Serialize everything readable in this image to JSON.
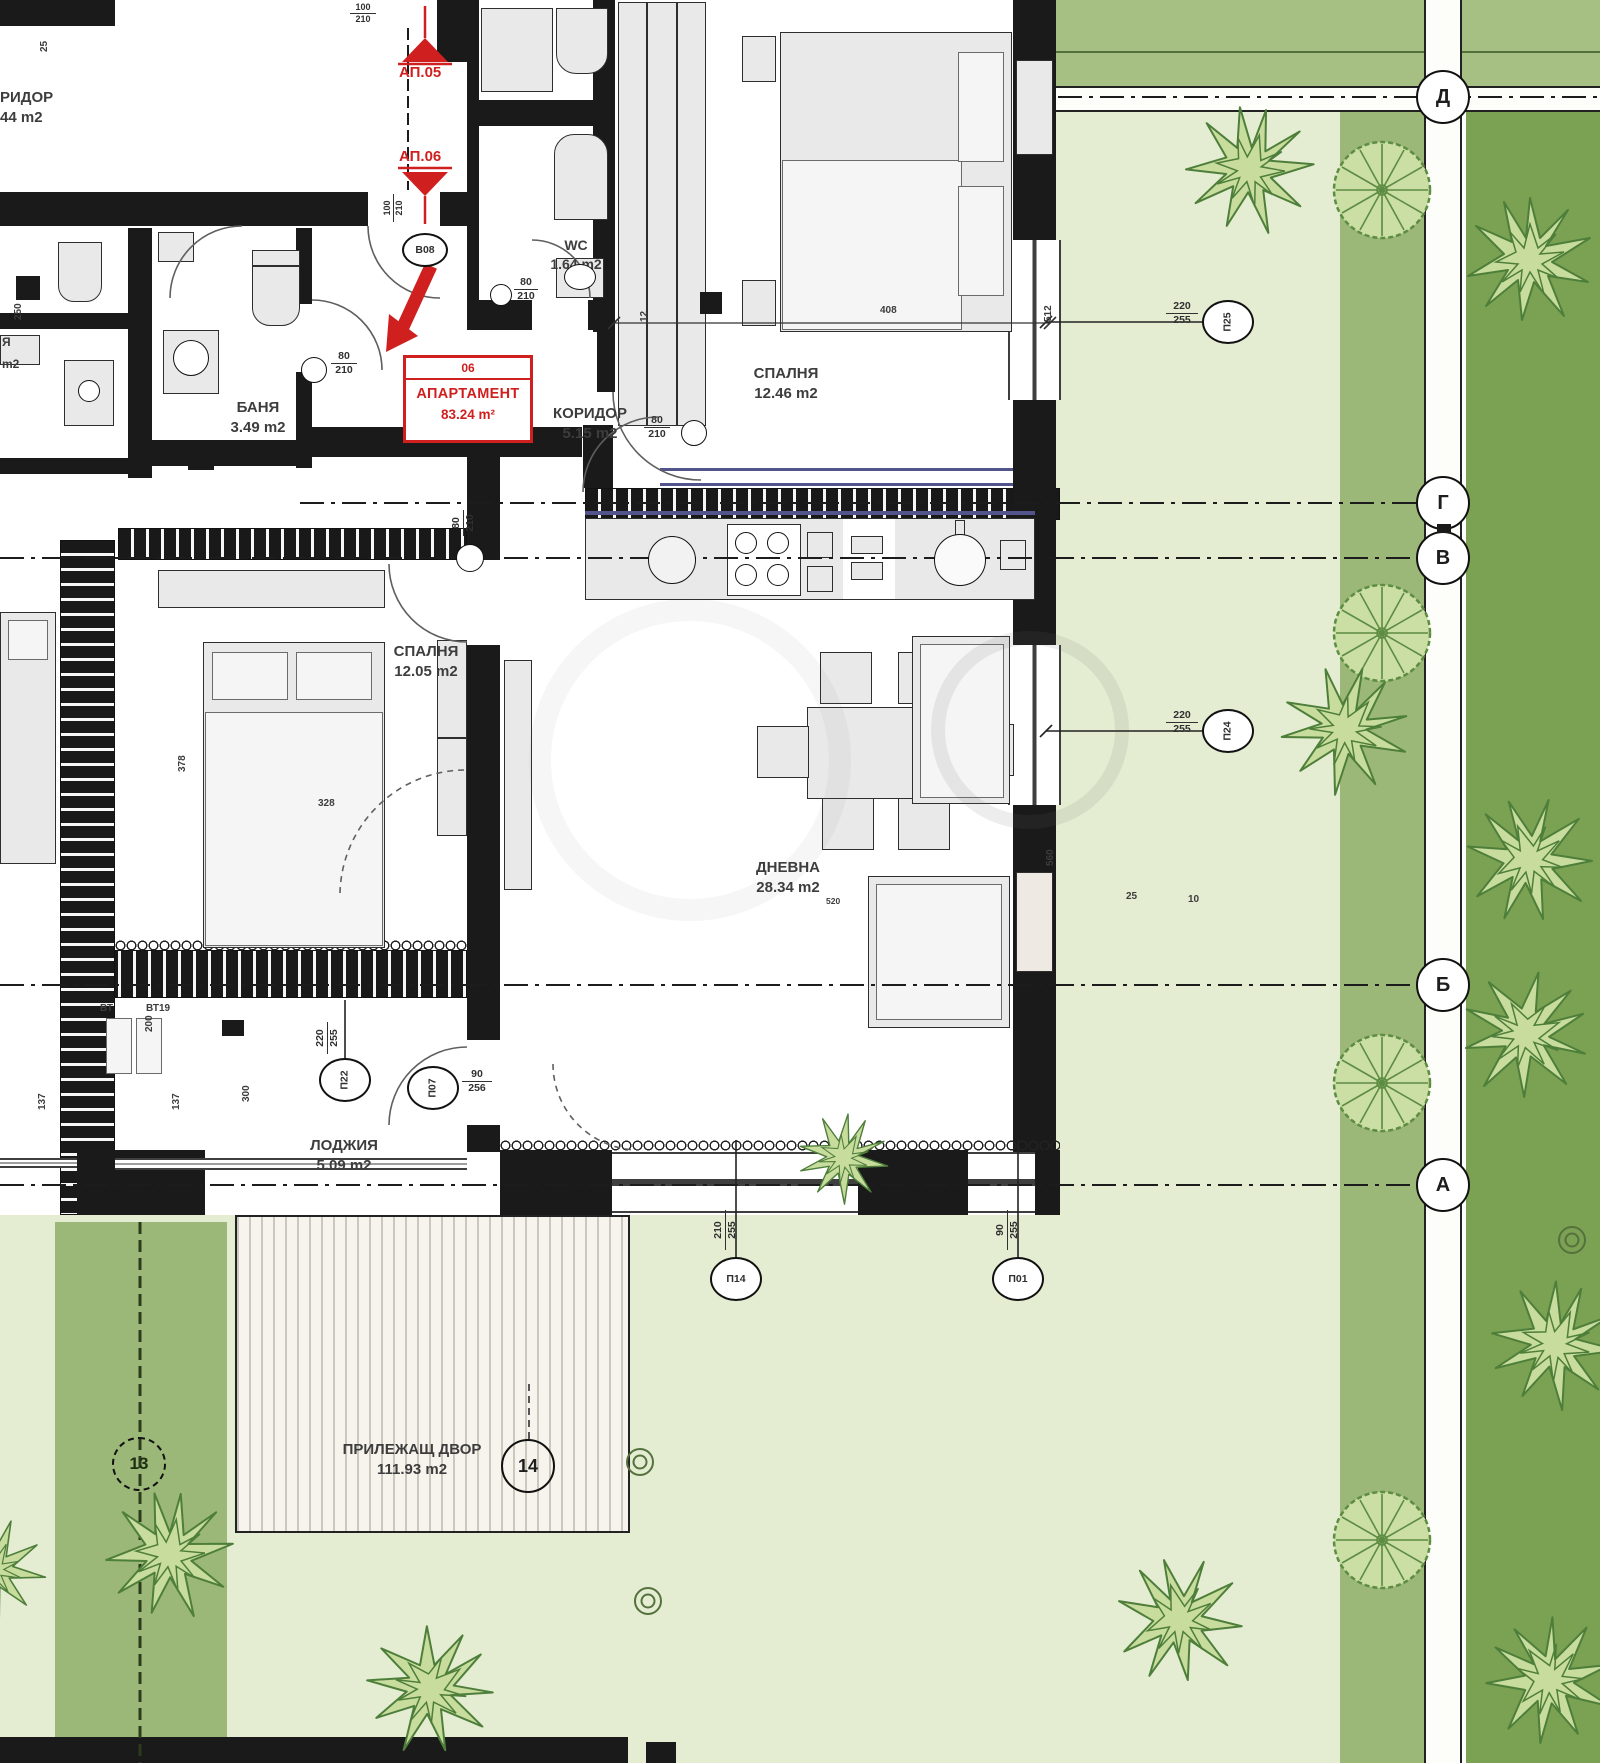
{
  "document": {
    "type": "apartment floor plan"
  },
  "highlight": {
    "number": "06",
    "title": "АПАРТАМЕНТ",
    "area": "83.24 m²"
  },
  "pointers": {
    "ap05": "АП.05",
    "ap06": "АП.06"
  },
  "rooms": [
    {
      "name": "РИДОР",
      "area": "44 m2"
    },
    {
      "name": "WC",
      "area": "1.64 m2"
    },
    {
      "name": "СПАЛНЯ",
      "area": "12.46 m2"
    },
    {
      "name": "КОРИДОР",
      "area": "5.15 m2"
    },
    {
      "name": "БАНЯ",
      "area": "3.49 m2"
    },
    {
      "name": "СПАЛНЯ",
      "area": "12.05 m2"
    },
    {
      "name": "ДНЕВНА",
      "area": "28.34 m2",
      "note": "520"
    },
    {
      "name": "ЛОДЖИЯ",
      "area": "5.09 m2"
    },
    {
      "name": "ПРИЛЕЖАЩ ДВОР",
      "area": "111.93 m2"
    }
  ],
  "axes": [
    "Д",
    "Г",
    "В",
    "Б",
    "А"
  ],
  "plots": [
    "13",
    "14"
  ],
  "openings": {
    "entry": {
      "id": "В08"
    },
    "p25": {
      "id": "П25",
      "w": "220",
      "h": "255"
    },
    "p24": {
      "id": "П24",
      "w": "220",
      "h": "255"
    },
    "p22": {
      "id": "П22",
      "w": "220",
      "h": "255"
    },
    "p07": {
      "id": "П07",
      "w": "90",
      "h": "256"
    },
    "p14": {
      "id": "П14",
      "w": "210",
      "h": "255"
    },
    "p01": {
      "id": "П01",
      "w": "90",
      "h": "255"
    }
  },
  "door_tags": [
    {
      "w": "100",
      "h": "210"
    },
    {
      "w": "100",
      "h": "210"
    },
    {
      "w": "80",
      "h": "210"
    },
    {
      "w": "80",
      "h": "210"
    },
    {
      "w": "80",
      "h": "210"
    },
    {
      "w": "80",
      "h": "210"
    }
  ],
  "dims": [
    "408",
    "378",
    "328",
    "560",
    "512",
    "300",
    "200",
    "137",
    "137",
    "250",
    "25",
    "25",
    "10",
    "12"
  ],
  "vents": [
    "ВТ",
    "ВТ19"
  ],
  "fragments": [
    "Я",
    "m2"
  ],
  "colors": {
    "accent_red": "#cf1f1f",
    "grass_pale": "#e4edd2",
    "grass_mid": "#a6bf83",
    "grass_dark": "#7ba153",
    "sill_purple": "#54548c"
  }
}
